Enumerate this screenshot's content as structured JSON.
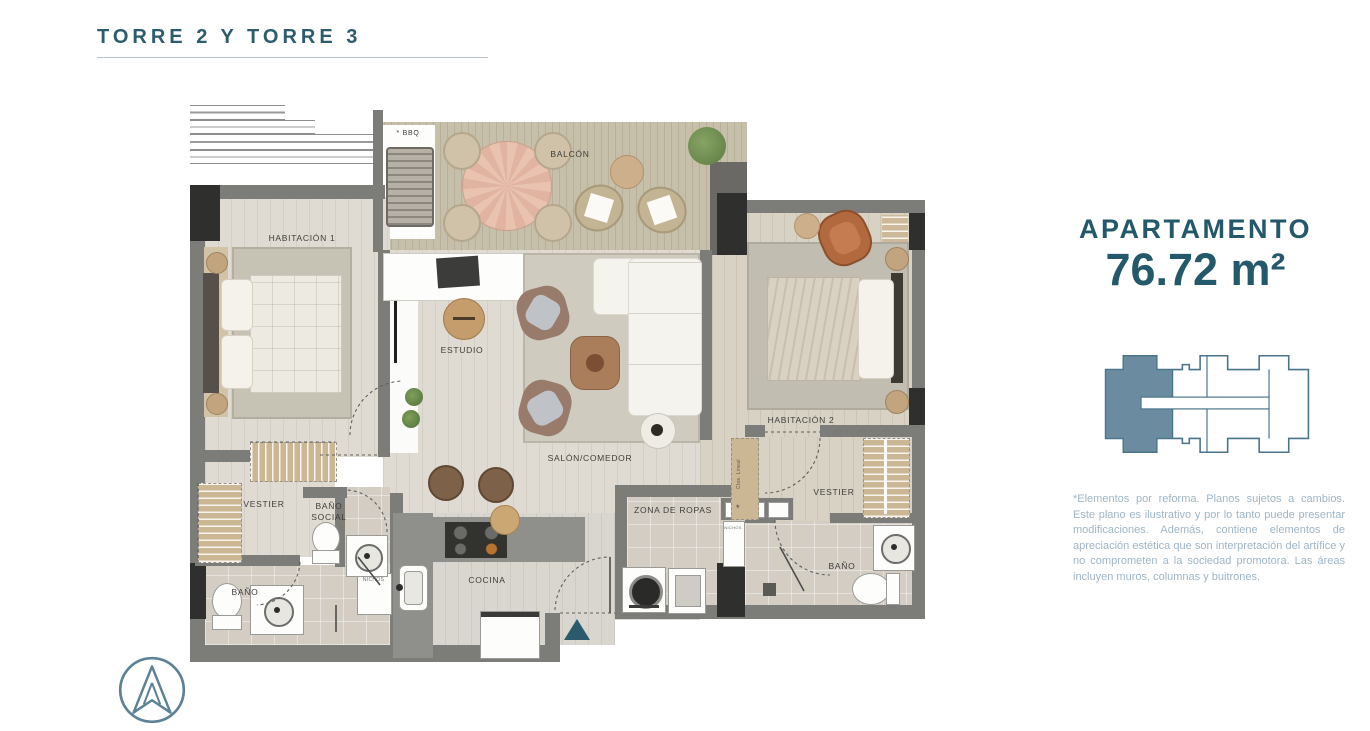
{
  "header": {
    "title": "TORRE 2 Y TORRE 3"
  },
  "info_panel": {
    "label": "APARTAMENTO",
    "area": "76.72 m²",
    "disclaimer": "*Elementos por reforma. Planos sujetos a cambios. Este plano es ilustrativo y por lo tanto puede presentar modificaciones. Además, contiene elementos de apreciación estética que son interpretación del artífice y no comprometen a la sociedad promotora. Las áreas incluyen muros, columnas y buitrones."
  },
  "plan": {
    "labels": {
      "balcon": "BALCÓN",
      "bbq": "* BBQ",
      "habitacion_1": "HABITACIÓN 1",
      "habitacion_2": "HABITACIÓN 2",
      "estudio": "ESTUDIO",
      "salon_comedor": "SALÓN/COMEDOR",
      "vestier_1": "VESTIER",
      "vestier_2": "VESTIER",
      "bano_social": "BAÑO SOCIAL",
      "bano_1": "BAÑO",
      "bano_2": "BAÑO",
      "cocina": "COCINA",
      "zona_ropas": "ZONA DE ROPAS",
      "nichos_1": "NICHOS",
      "nichos_2": "NICHOS",
      "clos_lineal": "Clos. Lineal",
      "reforma_mark": "*"
    }
  },
  "colors": {
    "accent_teal": "#2d5c6c",
    "disclaimer_text": "#9fb6c6",
    "keyplan_highlight": "#6b8ca0",
    "keyplan_stroke": "#4a7489",
    "wall_gray": "#7c7c79",
    "entrance_arrow": "#2b5a6d"
  },
  "icons": {
    "compass": "north-arrow-compass-icon"
  }
}
